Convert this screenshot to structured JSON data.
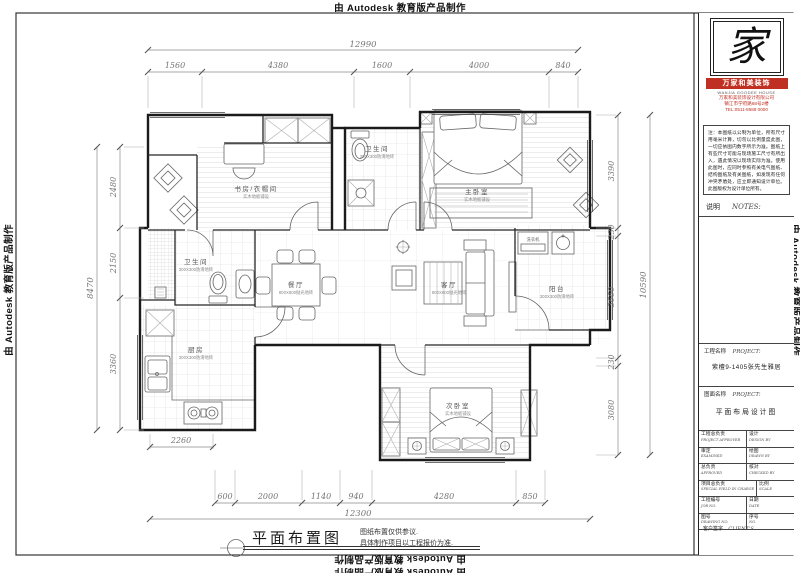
{
  "credits": {
    "top": "由 Autodesk 教育版产品制作",
    "bottom": "由 Autodesk 教育版产品制作",
    "bottom2": "由 Autodesk 教育版产品制作",
    "left": "由 Autodesk 教育版产品制作",
    "right": "由 Autodesk 教育版产品制作"
  },
  "title_block": {
    "logo_glyph": "家",
    "brand": "万家和美装饰",
    "brand_sub": "WANJIA GOODEE HOUSE",
    "company": "万家和美装饰设计有限公司",
    "address": "镇江市学府路68号2楼",
    "phone": "TEL:0511-8588 0000",
    "notes": "注：本图纸以公制为单位，所有尺寸用毫米计算，切勿以比例量度此图，一切应依图内数字所示为准。图纸上有些尺寸可能与现场施工尺寸有所出入，遇此情况以现场实际为准。使用此图时，应同时参照有关电气图纸、结构图纸及有关图纸，如发现有任何冲突矛盾处，应立即通知设计单位。此图版权为设计单位所有。",
    "notes_label_zh": "说明",
    "notes_label_en": "NOTES:",
    "project_label_zh": "工程名称",
    "project_label_en": "PROJECT:",
    "project_value": "紫檀9-1405张先生雅居",
    "drawing_label_zh": "图面名称",
    "drawing_label_en": "PROJECT:",
    "drawing_value": "平面布局设计图",
    "table": [
      {
        "zh": "工程总负责",
        "en": "PROJECT APPROVER"
      },
      {
        "zh": "设计",
        "en": "DESIGN BY"
      },
      {
        "zh": "审定",
        "en": "EXAMINED"
      },
      {
        "zh": "绘图",
        "en": "DRAWN BY"
      },
      {
        "zh": "总负责",
        "en": "APPROVED"
      },
      {
        "zh": "核对",
        "en": "CHECKED BY"
      },
      {
        "zh": "项目总负责",
        "en": "SPECIAL FIELD IN CHARGE"
      },
      {
        "zh": "比例",
        "en": "SCALE"
      },
      {
        "zh": "工程编号",
        "en": "JOB NO."
      },
      {
        "zh": "日期",
        "en": "DATE"
      },
      {
        "zh": "图号",
        "en": "DRAWING NO."
      },
      {
        "zh": "序号",
        "en": "NO."
      }
    ],
    "client_zh": "客户签字",
    "client_en": "CLIENT'S"
  },
  "footer": {
    "title": "平面布置图",
    "note1": "图纸布置仅供参议.",
    "note2": "具体制作项目以工程报价为准."
  },
  "dims": {
    "top": {
      "total": "12990",
      "segs": [
        "1560",
        "4380",
        "1600",
        "4000",
        "840"
      ]
    },
    "bottom": {
      "total": "12300",
      "segs": [
        "600",
        "2000",
        "1140",
        "940",
        "4280",
        "850"
      ]
    },
    "left": {
      "total": "8470",
      "segs": [
        "2480",
        "2150",
        "3360"
      ]
    },
    "right": {
      "total": "10590",
      "segs": [
        "3390",
        "230",
        "3660",
        "230",
        "3080"
      ]
    },
    "kitchen": "2260"
  },
  "rooms": [
    {
      "name": "书房/衣帽间",
      "spec": "实木地板铺设"
    },
    {
      "name": "卫生间",
      "spec": "300X300防滑地砖"
    },
    {
      "name": "主卧室",
      "spec": "实木地板铺设"
    },
    {
      "name": "餐厅",
      "spec": "800X800抛光地砖"
    },
    {
      "name": "客厅",
      "spec": "800X800抛光地砖"
    },
    {
      "name": "卫生间",
      "spec": "300X300防滑地砖"
    },
    {
      "name": "厨房",
      "spec": "300X300防滑地砖"
    },
    {
      "name": "次卧室",
      "spec": "实木地板铺设"
    },
    {
      "name": "阳台",
      "spec": "300X300防滑地砖"
    },
    {
      "name": "洗衣机",
      "spec": ""
    }
  ]
}
